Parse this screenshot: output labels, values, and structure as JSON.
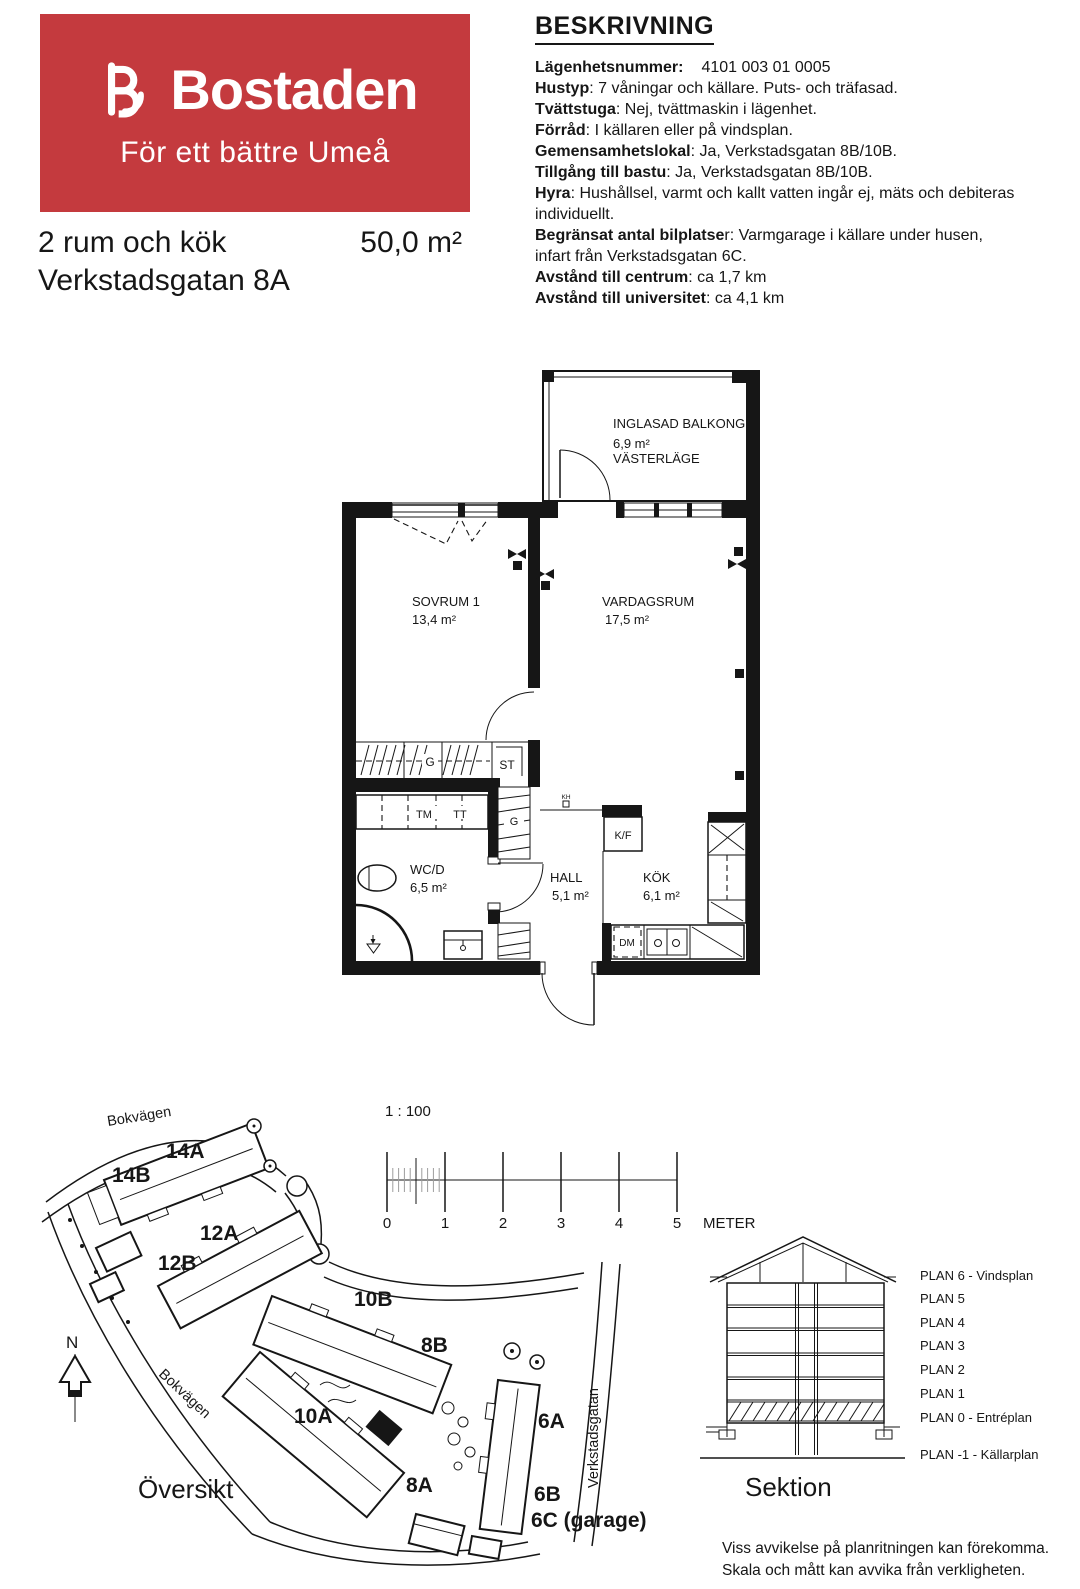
{
  "header": {
    "brand": "Bostaden",
    "tagline": "För ett bättre Umeå",
    "brand_red": "#C43A3E",
    "apartment_type": "2 rum och kök",
    "area": "50,0 m²",
    "address": "Verkstadsgatan 8A"
  },
  "description": {
    "title": "BESKRIVNING",
    "items": [
      {
        "label": "Lägenhetsnummer:",
        "value": "4101 003 01 0005"
      },
      {
        "label": "Hustyp",
        "value": ": 7 våningar och källare. Puts- och träfasad."
      },
      {
        "label": "Tvättstuga",
        "value": ": Nej, tvättmaskin i lägenhet."
      },
      {
        "label": "Förråd",
        "value": ": I källaren eller på vindsplan."
      },
      {
        "label": "Gemensamhetslokal",
        "value": ": Ja, Verkstadsgatan 8B/10B."
      },
      {
        "label": "Tillgång till bastu",
        "value": ": Ja, Verkstadsgatan 8B/10B."
      },
      {
        "label": "Hyra",
        "value": ": Hushållsel, varmt och kallt vatten ingår ej, mäts och debiteras individuellt."
      },
      {
        "label": "Begränsat antal bilplatse",
        "value": "r: Varmgarage i källare under husen, infart från Verkstadsgatan 6C."
      },
      {
        "label": "Avstånd till centrum",
        "value": ": ca 1,7 km"
      },
      {
        "label": "Avstånd till universitet",
        "value": ": ca 4,1 km"
      }
    ]
  },
  "floorplan": {
    "balcony": {
      "name": "INGLASAD BALKONG",
      "area": "6,9 m²",
      "orientation": "VÄSTERLÄGE"
    },
    "rooms": {
      "sovrum": {
        "name": "SOVRUM 1",
        "area": "13,4 m²"
      },
      "vardagsrum": {
        "name": "VARDAGSRUM",
        "area": "17,5 m²"
      },
      "wc": {
        "name": "WC/D",
        "area": "6,5 m²"
      },
      "hall": {
        "name": "HALL",
        "area": "5,1 m²"
      },
      "kok": {
        "name": "KÖK",
        "area": "6,1 m²"
      }
    },
    "fixtures": {
      "garderob": "G",
      "garderob_hall": "G",
      "stad": "ST",
      "tvattmaskin": "TM",
      "torktumlare": "TT",
      "kyl_frys": "K/F",
      "diskmaskin": "DM",
      "kapphylla": "KH"
    }
  },
  "scalebar": {
    "ratio": "1 : 100",
    "ticks": [
      "0",
      "1",
      "2",
      "3",
      "4",
      "5"
    ],
    "unit": "METER"
  },
  "sitemap": {
    "title": "Översikt",
    "north": "N",
    "street_top": "Bokvägen",
    "street_left": "Bokvägen",
    "street_right": "Verkstadsgatan",
    "buildings": [
      "14A",
      "14B",
      "12A",
      "12B",
      "10B",
      "8B",
      "10A",
      "8A",
      "6A",
      "6B",
      "6C (garage)"
    ]
  },
  "section": {
    "title": "Sektion",
    "plans": [
      "PLAN 6 - Vindsplan",
      "PLAN 5",
      "PLAN 4",
      "PLAN 3",
      "PLAN 2",
      "PLAN 1",
      "PLAN 0 - Entréplan",
      "PLAN -1 - Källarplan"
    ]
  },
  "footer": {
    "line1": "Viss avvikelse på planritningen kan förekomma.",
    "line2": "Skala och mått kan avvika från verkligheten."
  }
}
